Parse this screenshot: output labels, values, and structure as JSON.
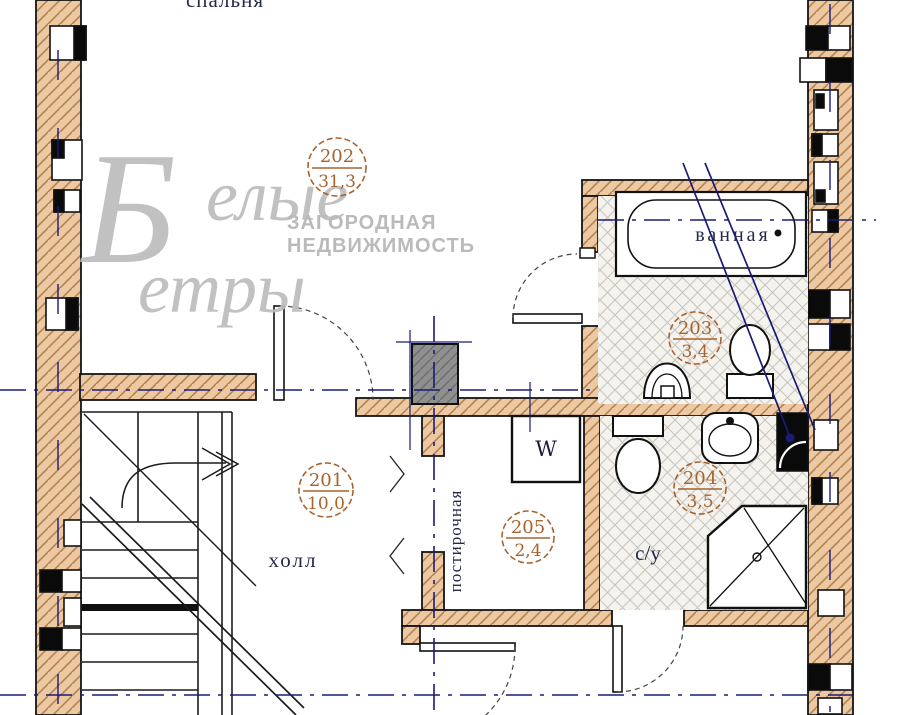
{
  "plan": {
    "title": "floor-plan-second-level",
    "watermark": {
      "big_letter": "Б",
      "word1_rest": "елые",
      "word2": "етры",
      "tagline1": "ЗАГОРОДНАЯ",
      "tagline2": "НЕДВИЖИМОСТЬ"
    },
    "rooms": {
      "bedroom": {
        "name": "спальня",
        "number": "202",
        "area": "31,3"
      },
      "hall": {
        "name": "холл",
        "number": "201",
        "area": "10,0"
      },
      "bathroom": {
        "name": "ванная",
        "number": "203",
        "area": "3,4"
      },
      "wc": {
        "name": "с/у",
        "number": "204",
        "area": "3,5"
      },
      "laundry": {
        "name": "постирочная",
        "number": "205",
        "area": "2,4"
      }
    },
    "appliances": {
      "washing_machine": "W"
    },
    "colors": {
      "wall_fill": "#ecc9a3",
      "wall_hatch": "#b5834e",
      "label_brown": "#a8632f",
      "room_text_navy": "#252a4d",
      "axis_blue": "#1b1b77",
      "watermark_gray": "#bcbcbc",
      "tile_line": "#c9c6c0",
      "shaft_gray": "#8f8f8f"
    }
  }
}
